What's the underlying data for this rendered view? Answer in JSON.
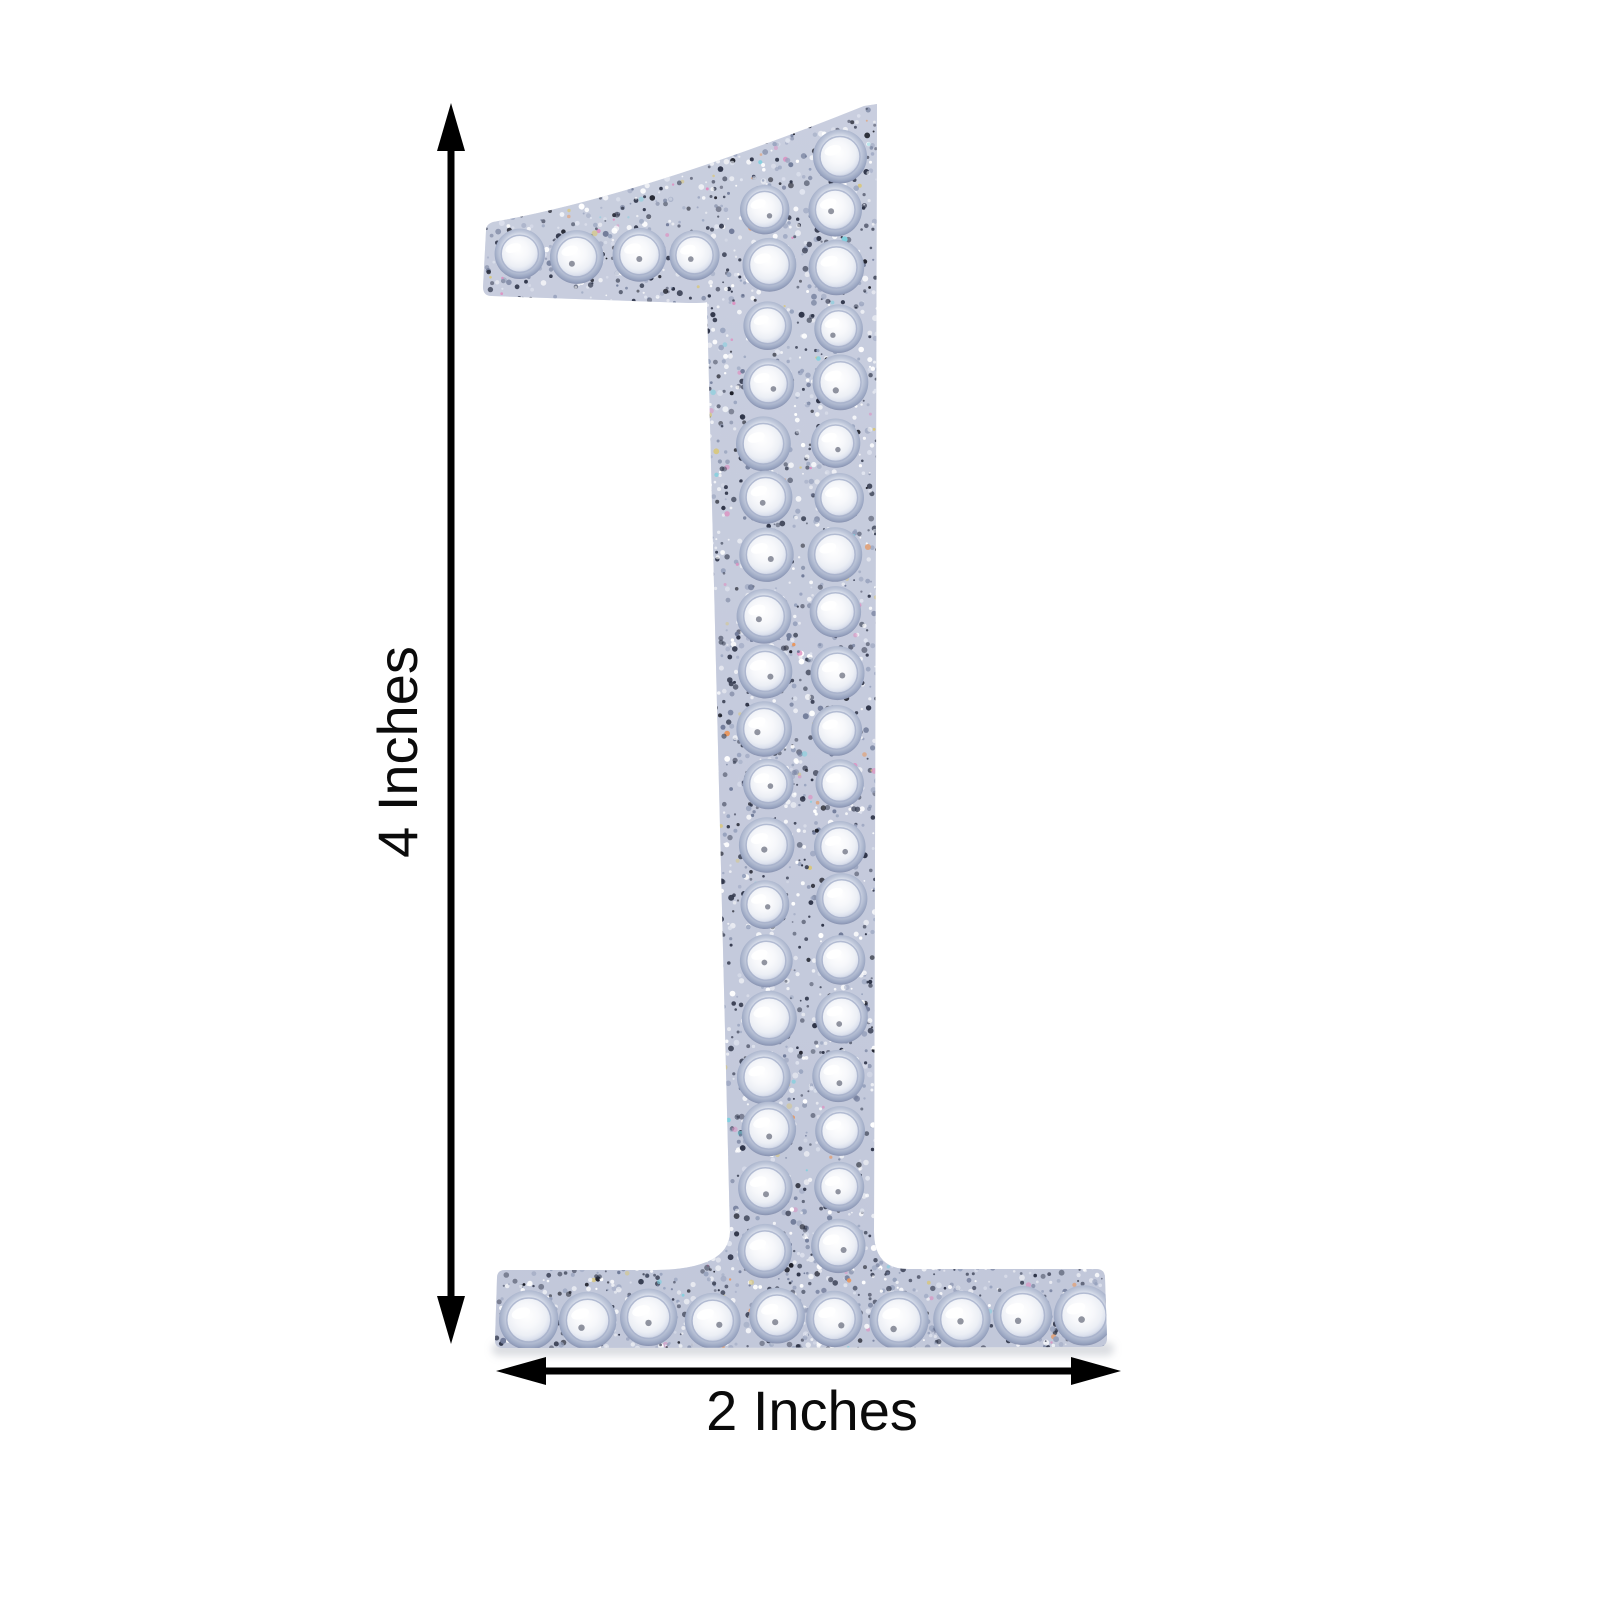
{
  "image": {
    "subject": "Silver rhinestone glitter self-adhesive number sticker",
    "digit": "1"
  },
  "annotations": {
    "height_label": "4 Inches",
    "width_label": "2 Inches"
  },
  "colors": {
    "background": "#ffffff",
    "dimension_line": "#000000",
    "label_text": "#0b0b0b",
    "glitter_base_top": "#ced4e2",
    "glitter_base_bottom": "#bfc6d8",
    "rhinestone_rim": "#9aa6c2",
    "rhinestone_face": "#f7f8fb",
    "shadow": "#c7cad1"
  },
  "figure": {
    "glitter_regions": [
      {
        "name": "flag",
        "x": 483,
        "y": 103,
        "w": 395,
        "h": 200,
        "count": 950
      },
      {
        "name": "stem",
        "x": 700,
        "y": 300,
        "w": 182,
        "h": 975,
        "count": 1900
      },
      {
        "name": "base",
        "x": 494,
        "y": 1266,
        "w": 615,
        "h": 84,
        "count": 760
      }
    ],
    "speckle_palette": [
      {
        "color": "#2e3448",
        "weight": 26
      },
      {
        "color": "#13151f",
        "weight": 6
      },
      {
        "color": "#ffffff",
        "weight": 27
      },
      {
        "color": "#97a2bd",
        "weight": 16
      },
      {
        "color": "#6f7a98",
        "weight": 10
      },
      {
        "color": "#e0e4ef",
        "weight": 8
      },
      {
        "color": "#de8fc0",
        "weight": 2
      },
      {
        "color": "#7fd0de",
        "weight": 2
      },
      {
        "color": "#d8c77e",
        "weight": 2
      },
      {
        "color": "#e8975f",
        "weight": 1
      }
    ],
    "stone_layout": {
      "serif_row": {
        "y": 254,
        "xs": [
          521,
          579,
          637,
          695
        ],
        "r": 26
      },
      "top_stone": {
        "x": 839,
        "y": 158,
        "r": 26
      },
      "stem_columns": {
        "x_left": 766,
        "x_right": 838,
        "y_start": 211,
        "y_end": 1248,
        "rows": 19,
        "r": 26
      },
      "base_row": {
        "y": 1318,
        "x_start": 527,
        "x_end": 1085,
        "count": 10,
        "r": 29
      }
    }
  }
}
